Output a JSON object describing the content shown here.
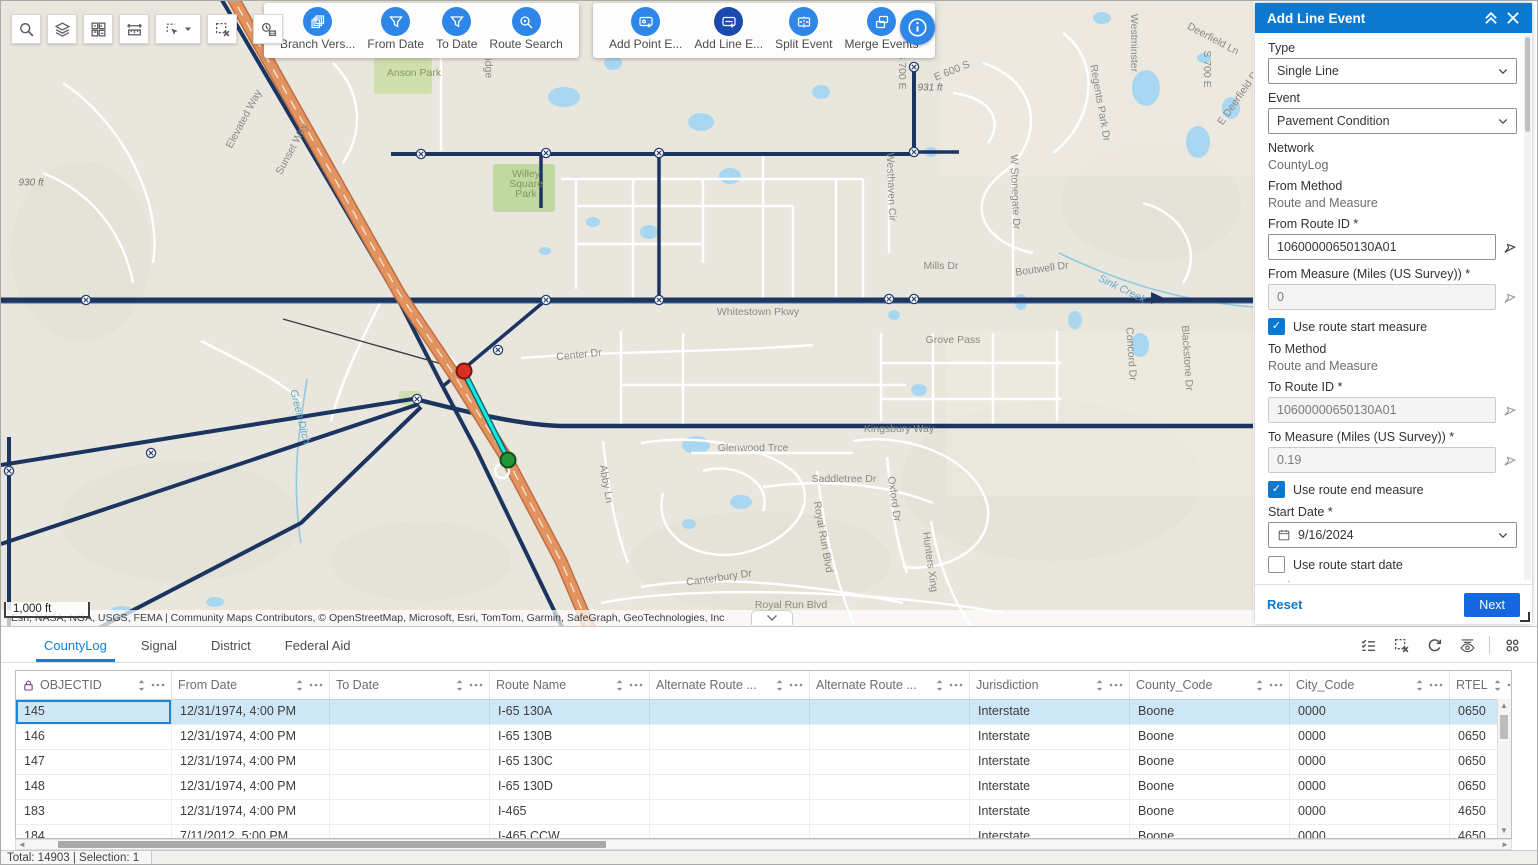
{
  "theme": {
    "header_blue": "#0b79d0",
    "tool_button_blue": "#2e86e8",
    "active_tool_blue": "#1b49ae",
    "next_button_blue": "#1566e0",
    "selection_cyan": "#17e6e2",
    "road_navy": "#1b3560",
    "highway_orange": "#e2935f",
    "selected_row_bg": "#cde7f6"
  },
  "map": {
    "scale_label": "1,000 ft",
    "attribution": "Esri, NASA, NGA, USGS, FEMA | Community Maps Contributors, © OpenStreetMap, Microsoft, Esri, TomTom, Garmin, SafeGraph, GeoTechnologies, Inc",
    "labels": [
      {
        "t": "930 ft",
        "x": 30,
        "y": 182,
        "r": 0,
        "c": "elev"
      },
      {
        "t": "Elevated Way",
        "x": 243,
        "y": 118,
        "r": -62,
        "c": "street"
      },
      {
        "t": "Sunset Way",
        "x": 291,
        "y": 148,
        "r": -62,
        "c": "street"
      },
      {
        "t": "Anson Park",
        "x": 413,
        "y": 72,
        "r": 0,
        "c": "park"
      },
      {
        "t": "Willey Square Park",
        "x": 525,
        "y": 183,
        "r": 0,
        "c": "park",
        "ml": true
      },
      {
        "t": "Aldridge",
        "x": 487,
        "y": 58,
        "r": 88,
        "c": "street"
      },
      {
        "t": "S 700 E",
        "x": 901,
        "y": 70,
        "r": 90,
        "c": "street"
      },
      {
        "t": "E 600 S",
        "x": 951,
        "y": 70,
        "r": -22,
        "c": "street"
      },
      {
        "t": "931 ft",
        "x": 929,
        "y": 87,
        "r": 0,
        "c": "elev"
      },
      {
        "t": "Westminster",
        "x": 1133,
        "y": 42,
        "r": 90,
        "c": "street"
      },
      {
        "t": "Regents Park Dr",
        "x": 1099,
        "y": 102,
        "r": 80,
        "c": "street"
      },
      {
        "t": "Deerfield Ln",
        "x": 1212,
        "y": 38,
        "r": 28,
        "c": "street"
      },
      {
        "t": "E Deerfield Dr",
        "x": 1238,
        "y": 96,
        "r": -55,
        "c": "street"
      },
      {
        "t": "Westhaven Cir",
        "x": 890,
        "y": 186,
        "r": 88,
        "c": "street"
      },
      {
        "t": "W Stonegate Dr",
        "x": 1014,
        "y": 191,
        "r": 88,
        "c": "street"
      },
      {
        "t": "S 700 E",
        "x": 1206,
        "y": 68,
        "r": 90,
        "c": "street"
      },
      {
        "t": "Mills Dr",
        "x": 940,
        "y": 265,
        "r": 0,
        "c": "street"
      },
      {
        "t": "Boutwell Dr",
        "x": 1041,
        "y": 268,
        "r": -8,
        "c": "street"
      },
      {
        "t": "Sink Creek",
        "x": 1121,
        "y": 288,
        "r": 26,
        "c": "water"
      },
      {
        "t": "Whitestown Pkwy",
        "x": 757,
        "y": 311,
        "r": 0,
        "c": "street"
      },
      {
        "t": "Grove Pass",
        "x": 952,
        "y": 339,
        "r": 0,
        "c": "street"
      },
      {
        "t": "Concord Dr",
        "x": 1130,
        "y": 353,
        "r": 86,
        "c": "street"
      },
      {
        "t": "Blackstone Dr",
        "x": 1186,
        "y": 357,
        "r": 86,
        "c": "street"
      },
      {
        "t": "Center Dr",
        "x": 578,
        "y": 354,
        "r": -6,
        "c": "street"
      },
      {
        "t": "Green Ditch",
        "x": 299,
        "y": 416,
        "r": 76,
        "c": "water"
      },
      {
        "t": "Glenwood Trce",
        "x": 752,
        "y": 447,
        "r": 0,
        "c": "street"
      },
      {
        "t": "Kingsbury Way",
        "x": 898,
        "y": 428,
        "r": 0,
        "c": "street"
      },
      {
        "t": "Saddletree Dr",
        "x": 843,
        "y": 478,
        "r": 0,
        "c": "street"
      },
      {
        "t": "Abby Ln",
        "x": 605,
        "y": 483,
        "r": 80,
        "c": "street"
      },
      {
        "t": "Royal Run Blvd",
        "x": 822,
        "y": 536,
        "r": 80,
        "c": "street"
      },
      {
        "t": "Oxford Dr",
        "x": 893,
        "y": 498,
        "r": 82,
        "c": "street"
      },
      {
        "t": "Hunters Xing",
        "x": 929,
        "y": 561,
        "r": 82,
        "c": "street"
      },
      {
        "t": "Canterbury Dr",
        "x": 718,
        "y": 577,
        "r": -8,
        "c": "street"
      },
      {
        "t": "Royal Run Blvd",
        "x": 790,
        "y": 604,
        "r": 0,
        "c": "street"
      }
    ]
  },
  "left_toolbar": {
    "buttons": [
      {
        "icon": "search-icon"
      },
      {
        "icon": "layers-icon"
      },
      {
        "icon": "basemap-grid-icon"
      },
      {
        "icon": "measure-icon"
      },
      {
        "icon": "select-tool-icon",
        "caret": true
      },
      {
        "icon": "clear-selection-icon"
      },
      {
        "icon": "time-extent-icon",
        "detached": true
      }
    ]
  },
  "edit_toolbar": {
    "groups": [
      {
        "buttons": [
          {
            "label": "Branch Vers...",
            "icon": "branch-version-icon"
          },
          {
            "label": "From Date",
            "icon": "filter-icon"
          },
          {
            "label": "To Date",
            "icon": "filter-icon"
          },
          {
            "label": "Route Search",
            "icon": "route-search-icon"
          }
        ]
      },
      {
        "buttons": [
          {
            "label": "Add Point E...",
            "icon": "add-point-event-icon"
          },
          {
            "label": "Add Line E...",
            "icon": "add-line-event-icon",
            "active": true
          },
          {
            "label": "Split Event",
            "icon": "split-event-icon"
          },
          {
            "label": "Merge Events",
            "icon": "merge-events-icon"
          }
        ]
      }
    ]
  },
  "panel": {
    "title": "Add Line Event",
    "type_label": "Type",
    "type_value": "Single Line",
    "event_label": "Event",
    "event_value": "Pavement Condition",
    "network_label": "Network",
    "network_value": "CountyLog",
    "from_method_label": "From Method",
    "from_method_value": "Route and Measure",
    "from_route_label": "From Route ID *",
    "from_route_value": "10600000650130A01",
    "from_measure_label": "From Measure (Miles (US Survey)) *",
    "from_measure_value": "0",
    "use_route_start_measure_label": "Use route start measure",
    "to_method_label": "To Method",
    "to_method_value": "Route and Measure",
    "to_route_label": "To Route ID *",
    "to_route_value": "10600000650130A01",
    "to_measure_label": "To Measure (Miles (US Survey)) *",
    "to_measure_value": "0.19",
    "use_route_end_measure_label": "Use route end measure",
    "start_date_label": "Start Date *",
    "start_date_value": "9/16/2024",
    "use_route_start_date_label": "Use route start date",
    "end_date_label": "End Date",
    "end_date_placeholder": "MM/DD/YYYY",
    "use_route_end_date_label": "Use route end date",
    "reset_label": "Reset",
    "next_label": "Next",
    "checks": {
      "use_route_start_measure": true,
      "use_route_end_measure": true,
      "use_route_start_date": false,
      "use_route_end_date": false
    }
  },
  "table": {
    "tabs": [
      {
        "label": "CountyLog",
        "active": true
      },
      {
        "label": "Signal"
      },
      {
        "label": "District"
      },
      {
        "label": "Federal Aid"
      }
    ],
    "toolbar_icons": [
      "show-selection-icon",
      "clear-selection-icon",
      "refresh-icon",
      "toggle-columns-icon",
      "options-grid-icon"
    ],
    "columns": [
      {
        "label": "OBJECTID",
        "locked": true
      },
      {
        "label": "From Date"
      },
      {
        "label": "To Date"
      },
      {
        "label": "Route Name"
      },
      {
        "label": "Alternate Route ..."
      },
      {
        "label": "Alternate Route ..."
      },
      {
        "label": "Jurisdiction"
      },
      {
        "label": "County_Code"
      },
      {
        "label": "City_Code"
      },
      {
        "label": "RTEL"
      }
    ],
    "rows": [
      {
        "selected": true,
        "cells": [
          "145",
          "12/31/1974, 4:00 PM",
          "",
          "I-65 130A",
          "",
          "",
          "Interstate",
          "Boone",
          "0000",
          "0650"
        ]
      },
      {
        "cells": [
          "146",
          "12/31/1974, 4:00 PM",
          "",
          "I-65 130B",
          "",
          "",
          "Interstate",
          "Boone",
          "0000",
          "0650"
        ]
      },
      {
        "cells": [
          "147",
          "12/31/1974, 4:00 PM",
          "",
          "I-65 130C",
          "",
          "",
          "Interstate",
          "Boone",
          "0000",
          "0650"
        ]
      },
      {
        "cells": [
          "148",
          "12/31/1974, 4:00 PM",
          "",
          "I-65 130D",
          "",
          "",
          "Interstate",
          "Boone",
          "0000",
          "0650"
        ]
      },
      {
        "cells": [
          "183",
          "12/31/1974, 4:00 PM",
          "",
          "I-465",
          "",
          "",
          "Interstate",
          "Boone",
          "0000",
          "4650"
        ]
      },
      {
        "cells": [
          "184",
          "7/11/2012, 5:00 PM",
          "",
          "I-465 CCW",
          "",
          "",
          "Interstate",
          "Boone",
          "0000",
          "4650"
        ]
      }
    ],
    "status": "Total: 14903 | Selection: 1"
  }
}
